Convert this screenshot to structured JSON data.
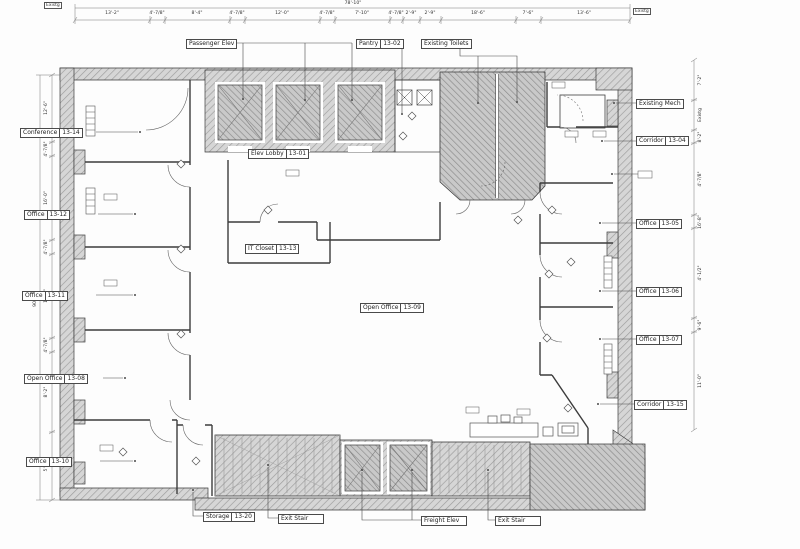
{
  "rooms": {
    "passenger_elev": {
      "name": "Passenger Elev",
      "number": ""
    },
    "pantry": {
      "name": "Pantry",
      "number": "13-02"
    },
    "existing_toilets": {
      "name": "Existing Toilets",
      "number": ""
    },
    "existing_mech": {
      "name": "Existing Mech",
      "number": ""
    },
    "corridor_04": {
      "name": "Corridor",
      "number": "13-04"
    },
    "office_05": {
      "name": "Office",
      "number": "13-05"
    },
    "office_06": {
      "name": "Office",
      "number": "13-06"
    },
    "office_07": {
      "name": "Office",
      "number": "13-07"
    },
    "corridor_15": {
      "name": "Corridor",
      "number": "13-15"
    },
    "elev_lobby": {
      "name": "Elev Lobby",
      "number": "13-01"
    },
    "it_closet": {
      "name": "IT Closet",
      "number": "13-13"
    },
    "open_office_09": {
      "name": "Open Office",
      "number": "13-09"
    },
    "conference": {
      "name": "Conference",
      "number": "13-14"
    },
    "office_12": {
      "name": "Office",
      "number": "13-12"
    },
    "office_11": {
      "name": "Office",
      "number": "13-11"
    },
    "open_office_08": {
      "name": "Open Office",
      "number": "13-08"
    },
    "office_10": {
      "name": "Office",
      "number": "13-10"
    },
    "storage": {
      "name": "Storage",
      "number": "13-20"
    },
    "exit_stair_1": {
      "name": "Exit Stair",
      "number": ""
    },
    "freight_elev": {
      "name": "Freight Elev",
      "number": ""
    },
    "exit_stair_2": {
      "name": "Exit Stair",
      "number": ""
    }
  },
  "dims": {
    "top": {
      "overall": "78'-10\"",
      "left_note": "Existg",
      "right_note": "Existg",
      "segments": [
        "13'-2\"",
        "4'-7/8\"",
        "8'-4\"",
        "4'-7/8\"",
        "12'-0\"",
        "4'-7/8\"",
        "7'-10\"",
        "4'-7/8\"",
        "2'-9\"",
        "2'-9\"",
        "18'-6\"",
        "7'-6\"",
        "13'-6\""
      ]
    },
    "left": {
      "overall": "90'-2\"",
      "segments": [
        "12'-6\"",
        "4'-7/8\"",
        "16'-0\"",
        "4'-7/8\"",
        "15'-8\"",
        "4'-7/8\"",
        "8'-2\"",
        "5'-0\""
      ]
    },
    "right": {
      "segments": [
        "7'-2\"",
        "Existg",
        "8'-2\"",
        "4'-7/8\"",
        "16'-8\"",
        "4'-1/2\"",
        "9'-6\"",
        "11'-0\""
      ]
    }
  }
}
